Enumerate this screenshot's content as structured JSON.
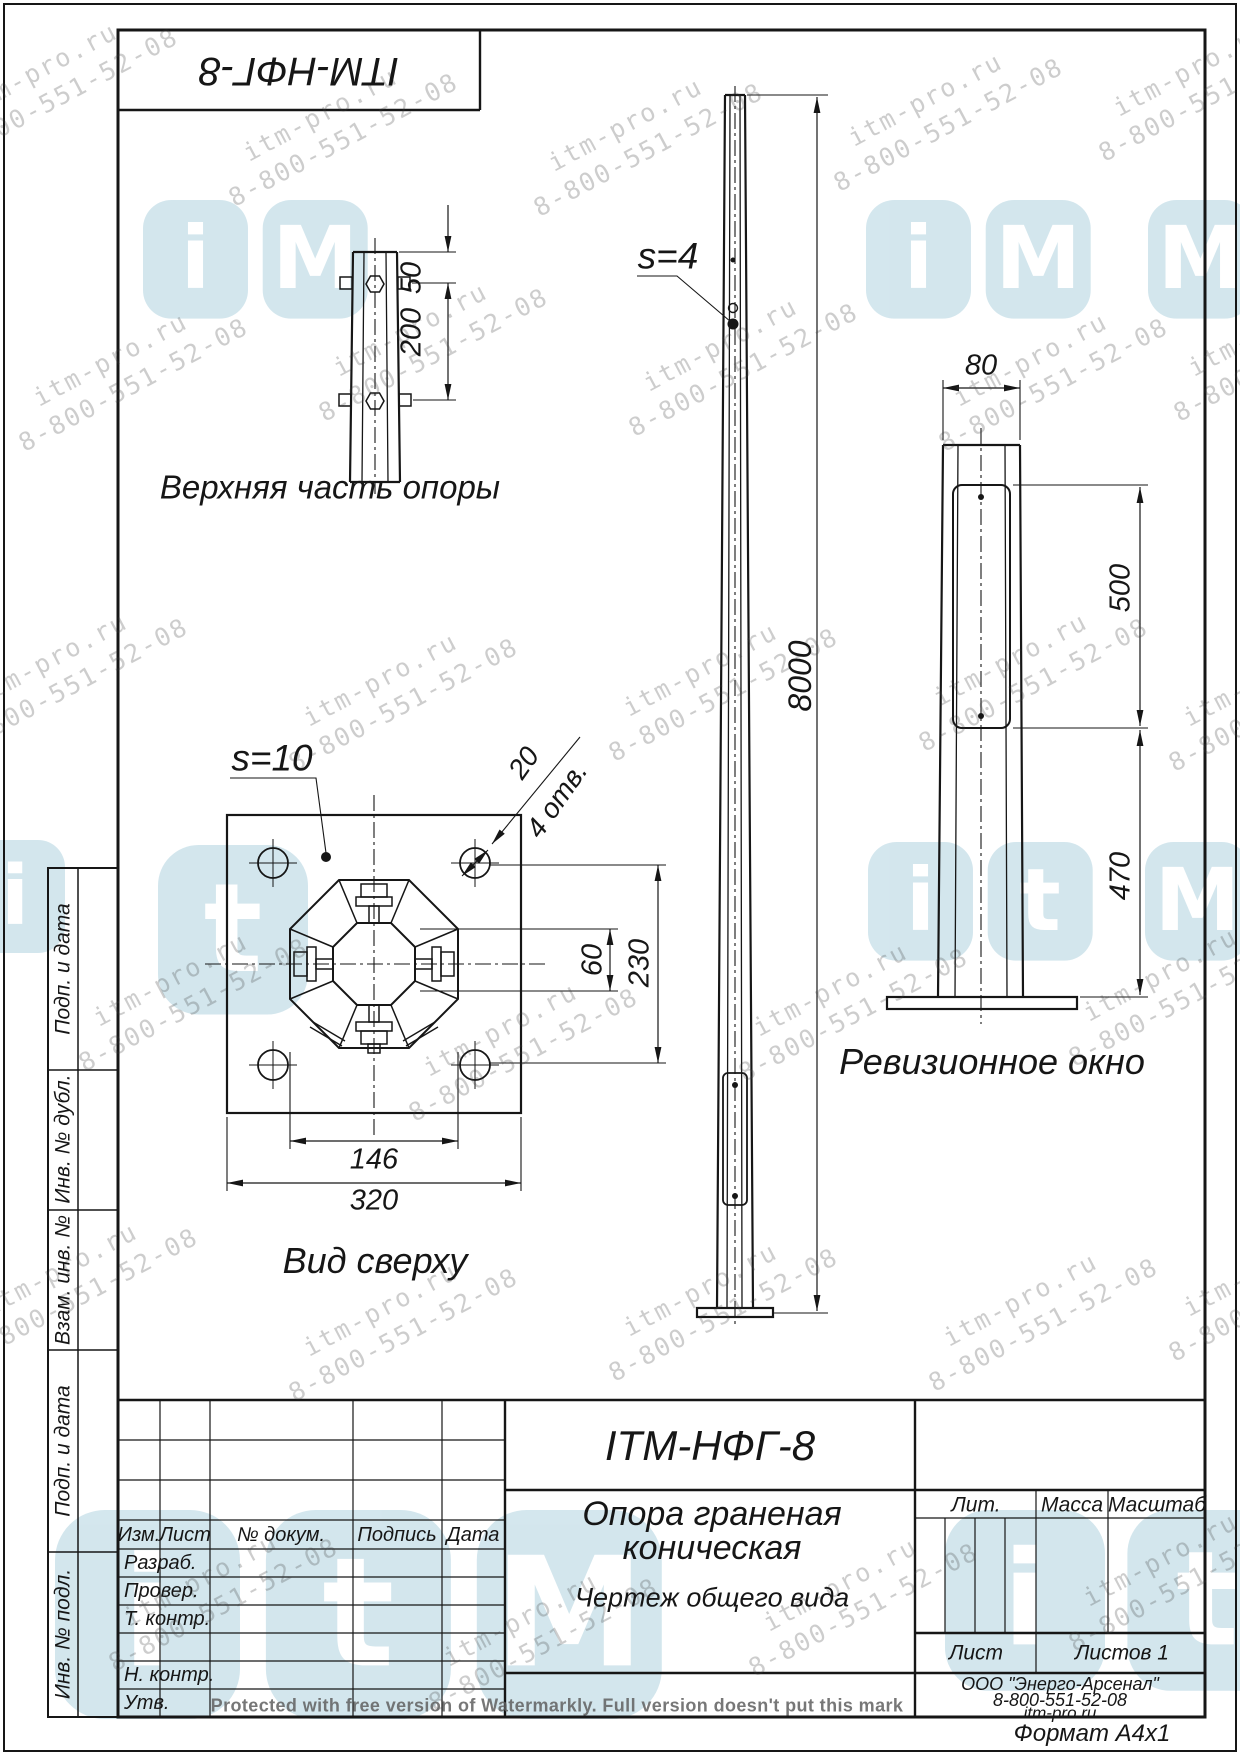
{
  "corner_stamp": {
    "designation": "ITM-НФГ-8"
  },
  "views": {
    "top_part": {
      "label": "Верхняя часть опоры",
      "dim_50": "50",
      "dim_200": "200"
    },
    "front": {
      "wall_callout": "s=4",
      "dim_height": "8000"
    },
    "plan": {
      "label": "Вид сверху",
      "wall_callout": "s=10",
      "dim_hole": "20",
      "holes_note": "4 отв.",
      "dim_60": "60",
      "dim_230": "230",
      "dim_146": "146",
      "dim_320": "320"
    },
    "side": {
      "label": "Ревизионное окно",
      "dim_80": "80",
      "dim_500": "500",
      "dim_470": "470"
    }
  },
  "margin_labels": [
    "Подп. и дата",
    "Инв. № дубл.",
    "Взам. инв. №",
    "Подп. и дата",
    "Инв. № подл."
  ],
  "title_block": {
    "designation": "ITM-НФГ-8",
    "title_line1": "Опора граненая",
    "title_line2": "коническая",
    "subtitle": "Чертеж общего вида",
    "cols": {
      "izm": "Изм.",
      "list": "Лист",
      "doc": "№ докум.",
      "sign": "Подпись",
      "date": "Дата"
    },
    "rows": {
      "dev": "Разраб.",
      "check": "Провер.",
      "tcontr": "Т. контр.",
      "ncontr": "Н. контр.",
      "approve": "Утв."
    },
    "lit": "Лит.",
    "mass": "Масса",
    "scale": "Масштаб",
    "sheet": "Лист",
    "sheets": "Листов 1",
    "company": "ООО \"Энерго-Арсенал\"",
    "phone": "8-800-551-52-08",
    "website": "itm-pro.ru",
    "format": "Формат  А4х1"
  },
  "watermark": {
    "line1": "itm-pro.ru",
    "line2": "8-800-551-52-08",
    "protected_note": "Protected with free version of Watermarkly. Full version doesn't put this mark",
    "logo_letters": [
      "i",
      "t",
      "M"
    ]
  }
}
